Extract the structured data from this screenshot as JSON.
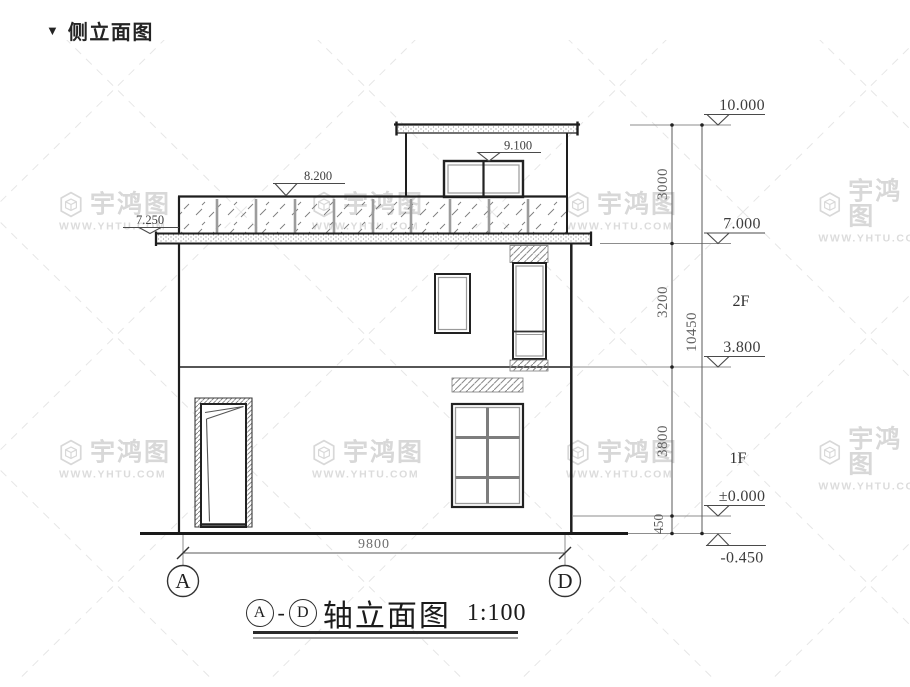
{
  "header": {
    "marker": "▼",
    "title": "侧立面图"
  },
  "watermark": {
    "brand": "宇鸿图",
    "site": "WWW.YHTU.COM"
  },
  "drawing": {
    "elevations": {
      "roof_top": "10.000",
      "stair_bulkhead": "9.100",
      "parapet_top": "8.200",
      "roof_slab_edge": "7.250",
      "roof_level": "7.000",
      "second_floor": "3.800",
      "first_floor": "±0.000",
      "site": "-0.450"
    },
    "dims": {
      "chain": [
        "3000",
        "3200",
        "3800",
        "450"
      ],
      "total_height": "10450",
      "total_width": "9800"
    },
    "floors": {
      "second": "2F",
      "first": "1F"
    },
    "axes": {
      "left": "A",
      "right": "D"
    }
  },
  "title_block": {
    "axis_left": "A",
    "separator": "-",
    "axis_right": "D",
    "name": "轴立面图",
    "scale": "1:100"
  }
}
